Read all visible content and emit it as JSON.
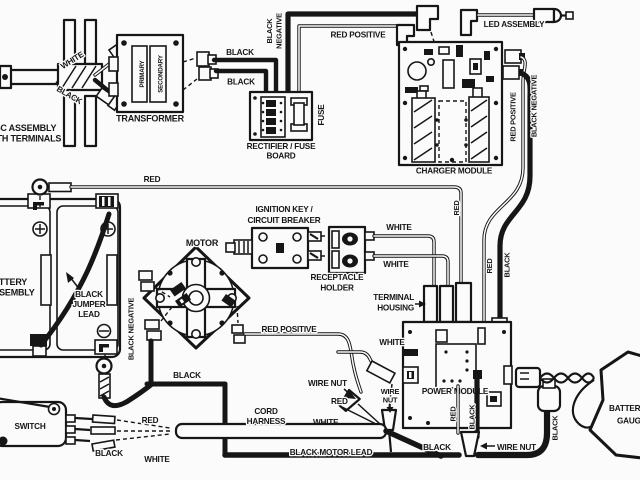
{
  "title": "electric-mower-wiring-diagram",
  "colors": {
    "ink": "#161616",
    "paper": "#fbfbfb"
  },
  "labels": {
    "white": "WHITE",
    "black": "BLACK",
    "red": "RED",
    "negative": "NEGATIVE",
    "red_positive": "RED POSITIVE",
    "black_negative": "BLACK NEGATIVE",
    "disc_line1": "DISC ASSEMBLY",
    "disc_line2": "WITH TERMINALS",
    "transformer": "TRANSFORMER",
    "primary": "PRIMARY",
    "secondary": "SECONDARY",
    "rectifier_line1": "RECTIFIER / FUSE",
    "rectifier_line2": "BOARD",
    "fuse": "FUSE",
    "led_assembly": "LED ASSEMBLY",
    "charger_module": "CHARGER MODULE",
    "battery": "BATTERY",
    "assembly": "ASSEMBLY",
    "jumper": "JUMPER",
    "lead": "LEAD",
    "ignition_line1": "IGNITION KEY /",
    "ignition_line2": "CIRCUIT BREAKER",
    "receptacle": "RECEPTACLE",
    "holder": "HOLDER",
    "motor": "MOTOR",
    "terminal": "TERMINAL",
    "housing": "HOUSING",
    "power_module": "POWER MODULE",
    "wire_nut": "WIRE NUT",
    "wire": "WIRE",
    "nut": "NUT",
    "switch": "SWITCH",
    "cord": "CORD",
    "harness": "HARNESS",
    "black_motor_lead": "BLACK MOTOR LEAD",
    "gauge": "GAUGE"
  }
}
